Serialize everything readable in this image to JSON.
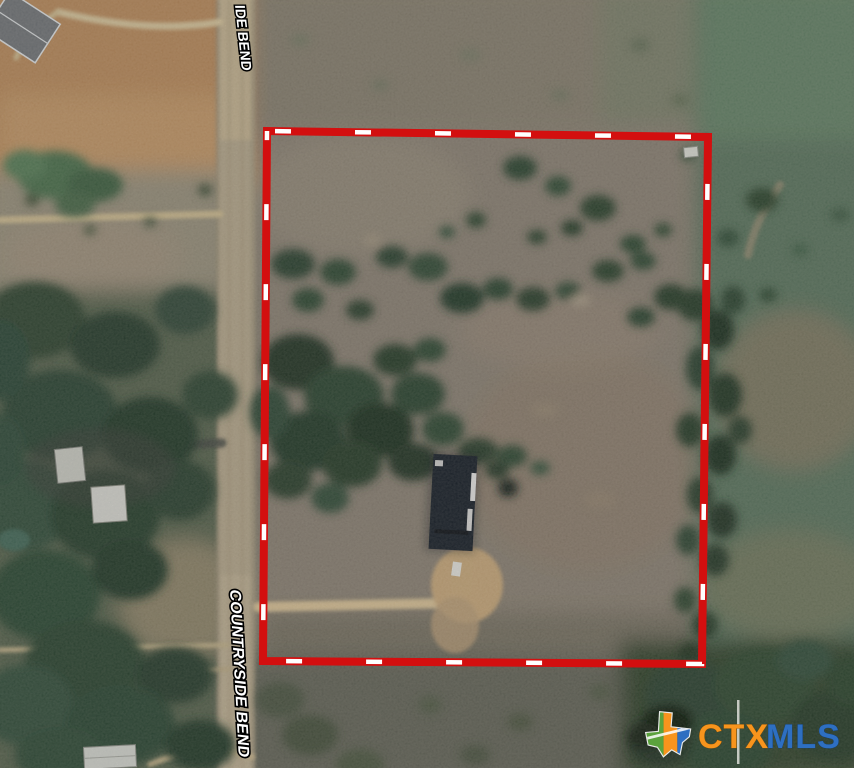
{
  "photo": {
    "road": {
      "label_top": "IDE BEND",
      "label_bottom": "COUNTRYSIDE BEND"
    },
    "boundary": {
      "line_color": "#d30f0f",
      "dash_color": "#ffffff"
    },
    "logo": {
      "prefix": "CTX",
      "suffix": "MLS",
      "prefix_color": "#f7941d",
      "suffix_color": "#2e6fc1"
    }
  }
}
